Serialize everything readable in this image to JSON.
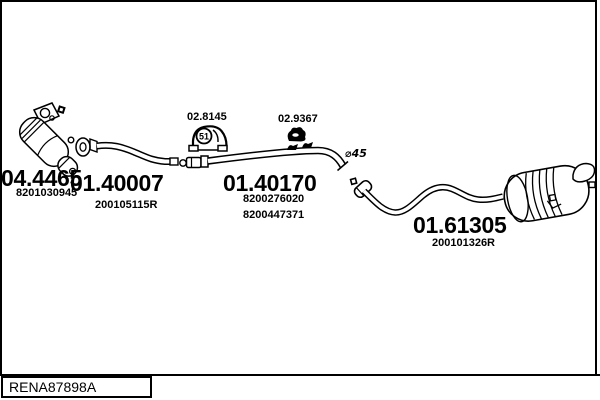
{
  "colors": {
    "line": "#000000",
    "background": "#ffffff"
  },
  "parts": [
    {
      "code": "04.4465",
      "refs": [
        "8201030945"
      ]
    },
    {
      "code": "01.40007",
      "refs": [
        "200105115R"
      ]
    },
    {
      "code": "01.40170",
      "refs": [
        "8200276020",
        "8200447371"
      ]
    },
    {
      "code": "01.61305",
      "refs": [
        "200101326R"
      ]
    }
  ],
  "accessories": [
    {
      "code": "02.8145",
      "icon": "rubber-hanger-icon",
      "badge": "51"
    },
    {
      "code": "02.9367",
      "icon": "clamp-icon"
    }
  ],
  "annotations": {
    "diameter": "⌀45"
  },
  "footer": {
    "code": "RENA87898A"
  }
}
